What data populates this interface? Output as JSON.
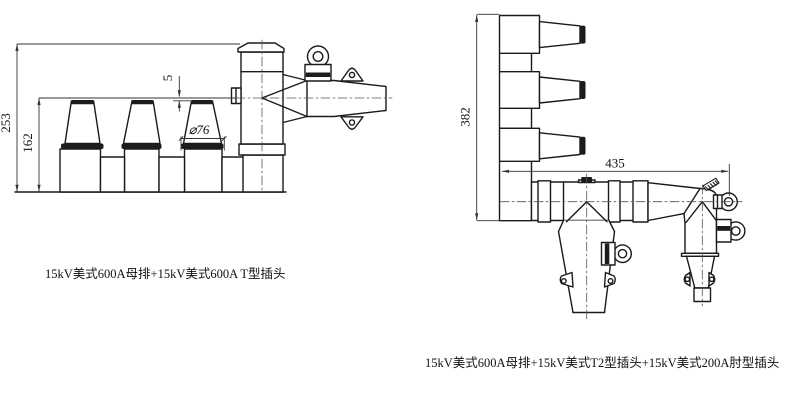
{
  "left_drawing": {
    "caption": "15kV美式600A母排+15kV美式600A T型插头",
    "dims": {
      "height_overall": "253",
      "height_bushing": "162",
      "offset_gap": "5",
      "bushing_diameter": "⌀76"
    }
  },
  "right_drawing": {
    "caption": "15kV美式600A母排+15kV美式T2型插头+15kV美式200A肘型插头",
    "dims": {
      "height_overall": "382",
      "length_overall": "435"
    }
  },
  "colors": {
    "object_line": "#1a1a1a",
    "dimension_line": "#333333",
    "dark_fill": "#1c1c1c",
    "background": "#ffffff"
  }
}
